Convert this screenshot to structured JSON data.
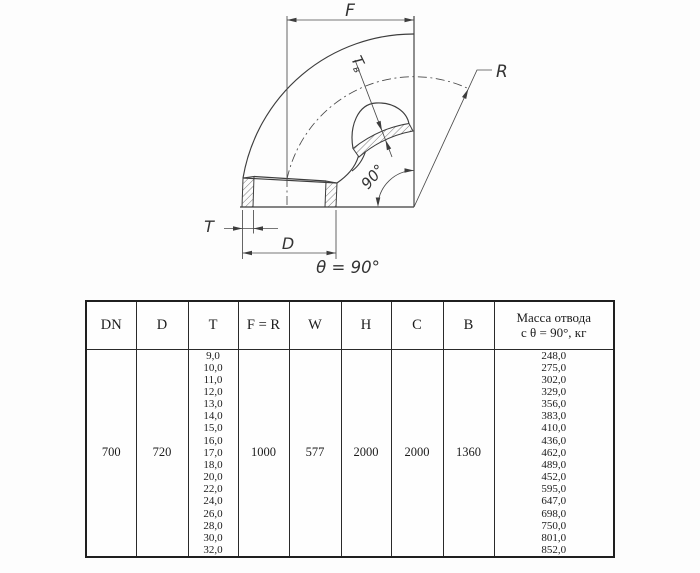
{
  "drawing": {
    "labels": {
      "f": "F",
      "r": "R",
      "t": "T",
      "d": "D",
      "tb_main": "T",
      "tb_sub": "в",
      "bend_angle": "90°",
      "caption": "θ = 90°"
    }
  },
  "table": {
    "headers": [
      "DN",
      "D",
      "T",
      "F = R",
      "W",
      "H",
      "C",
      "B"
    ],
    "mass_header": [
      "Масса отвода",
      "с θ =  90°, кг"
    ],
    "row": {
      "dn": "700",
      "d": "720",
      "t_values": [
        "9,0",
        "10,0",
        "11,0",
        "12,0",
        "13,0",
        "14,0",
        "15,0",
        "16,0",
        "17,0",
        "18,0",
        "20,0",
        "22,0",
        "24,0",
        "26,0",
        "28,0",
        "30,0",
        "32,0"
      ],
      "f_r": "1000",
      "w": "577",
      "h": "2000",
      "c": "2000",
      "b": "1360",
      "mass_values": [
        "248,0",
        "275,0",
        "302,0",
        "329,0",
        "356,0",
        "383,0",
        "410,0",
        "436,0",
        "462,0",
        "489,0",
        "452,0",
        "595,0",
        "647,0",
        "698,0",
        "750,0",
        "801,0",
        "852,0"
      ]
    }
  }
}
